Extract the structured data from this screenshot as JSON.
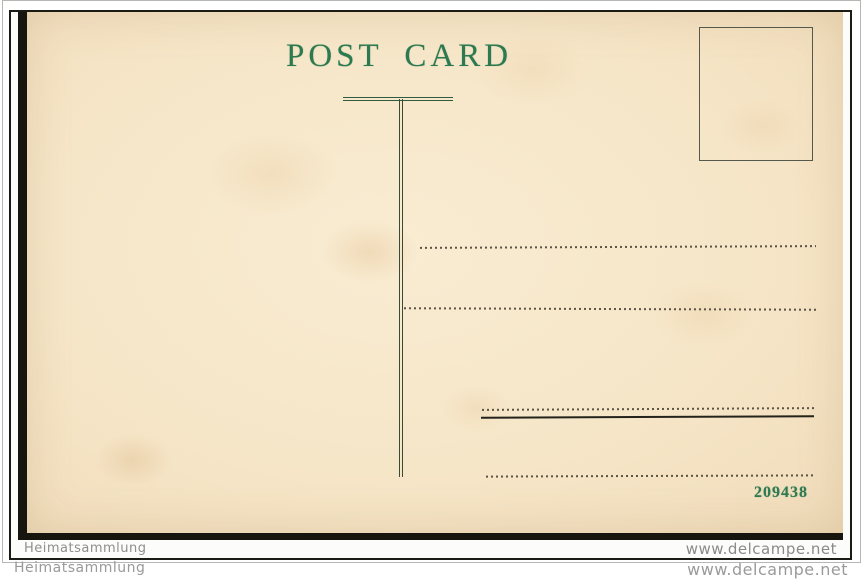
{
  "postcard": {
    "title": "POST CARD",
    "serial_number": "209438",
    "colors": {
      "card_paper": "#f6e6c8",
      "print_green": "#2e7a50",
      "rule_dark": "#4a4335",
      "scan_edge_black": "#16160f",
      "frame_border": "#1b1b16"
    }
  },
  "watermarks": {
    "inner_left": "Heimatsammlung",
    "inner_right": "www.delcampe.net",
    "outer_left": "Heimatsammlung",
    "outer_right": "www.delcampe.net"
  }
}
